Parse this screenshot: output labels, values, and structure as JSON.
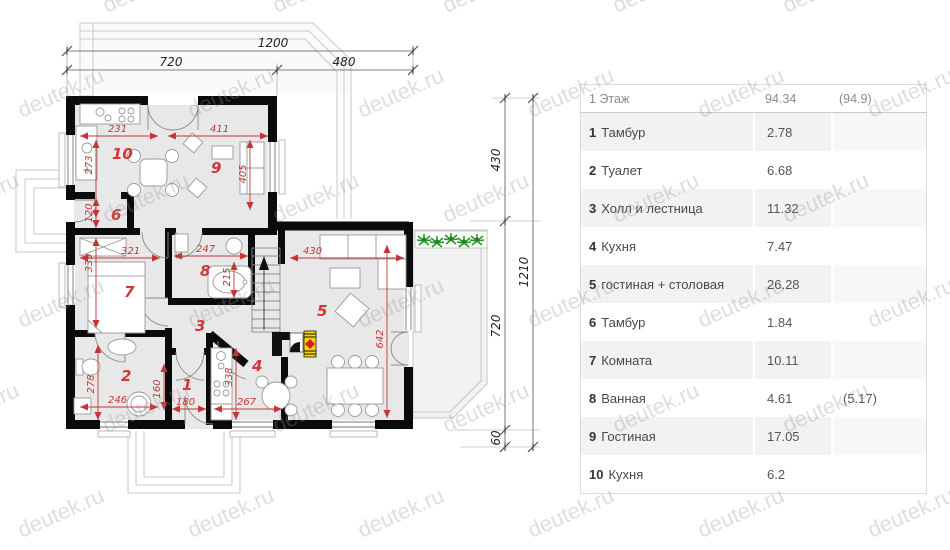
{
  "watermark": "deutek.ru",
  "table": {
    "header": {
      "label": "1 Этаж",
      "area": "94.34",
      "area_alt": "(94.9)"
    },
    "rows": [
      {
        "num": "1",
        "name": "Тамбур",
        "area": "2.78",
        "area_alt": ""
      },
      {
        "num": "2",
        "name": "Туалет",
        "area": "6.68",
        "area_alt": ""
      },
      {
        "num": "3",
        "name": "Холл и лестница",
        "area": "11.32",
        "area_alt": ""
      },
      {
        "num": "4",
        "name": "Кухня",
        "area": "7.47",
        "area_alt": ""
      },
      {
        "num": "5",
        "name": "гостиная + столовая",
        "area": "26.28",
        "area_alt": ""
      },
      {
        "num": "6",
        "name": "Тамбур",
        "area": "1.84",
        "area_alt": ""
      },
      {
        "num": "7",
        "name": "Комната",
        "area": "10.11",
        "area_alt": ""
      },
      {
        "num": "8",
        "name": "Ванная",
        "area": "4.61",
        "area_alt": "(5.17)"
      },
      {
        "num": "9",
        "name": "Гостиная",
        "area": "17.05",
        "area_alt": ""
      },
      {
        "num": "10",
        "name": "Кухня",
        "area": "6.2",
        "area_alt": ""
      }
    ]
  },
  "plan": {
    "outer_dims": {
      "top_total": "1200",
      "top_left": "720",
      "top_right": "480",
      "right_upper": "430",
      "right_middle": "720",
      "right_lower": "60",
      "right_total": "1210"
    },
    "room_numbers": {
      "r1": "1",
      "r2": "2",
      "r3": "3",
      "r4": "4",
      "r5": "5",
      "r6": "6",
      "r7": "7",
      "r8": "8",
      "r9": "9",
      "r10": "10"
    },
    "inner_dims": {
      "k10_w": "231",
      "k10_d": "273",
      "r9_w": "411",
      "r9_d": "405",
      "r6_h": "120",
      "r7_w": "321",
      "r7_d": "339",
      "r8_w": "247",
      "r8_d": "215",
      "r5_w": "430",
      "r5_d": "642",
      "r2_d": "278",
      "r2_w": "246",
      "r1_h": "160",
      "r1_w": "180",
      "r4_d": "338",
      "r4_w": "267"
    }
  }
}
